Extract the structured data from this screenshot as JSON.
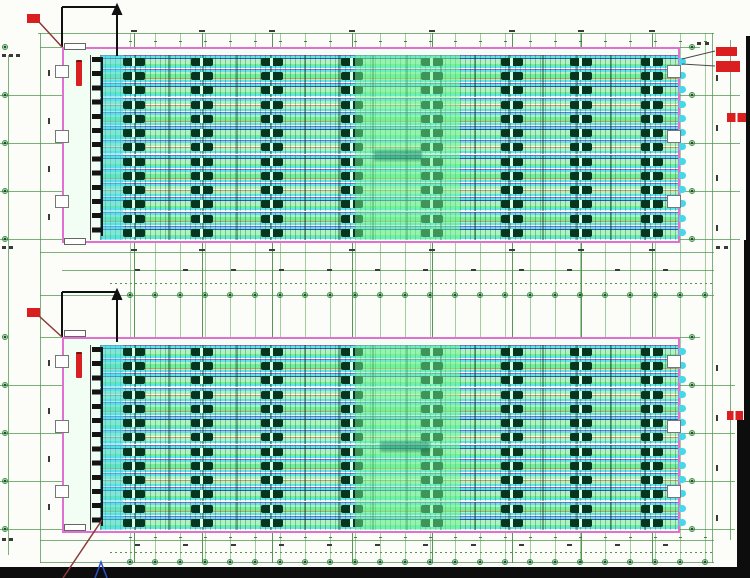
{
  "meta": {
    "description": "Scanned CAD floor plan: two identical long building plans with cage rows, dimension grids and red annotations. All small text is illegible at this resolution."
  },
  "canvas": {
    "w": 750,
    "h": 578,
    "bg": "#fcfcf9"
  },
  "palette": {
    "border_magenta": "#e26fd2",
    "grid_fine": "rgba(90,165,90,0.55)",
    "grid_bay": "rgba(60,130,60,0.85)",
    "grid_margin": "rgba(80,150,80,0.75)",
    "tick_dark": "#3a3a3a",
    "red": "#d91f1f",
    "leader_red": "#8a3a34",
    "leader_gray": "#4a4a4a",
    "cut_black": "#111111",
    "wall_black": "#141414",
    "blue_mark": "#2b50c8",
    "cyan_tint": "rgba(80,220,230,0.50)",
    "green_tint": "rgba(120,245,150,0.50)"
  },
  "grid": {
    "fine_x": {
      "start": 130,
      "step": 25,
      "count": 24,
      "y1": 33,
      "y2": 563
    },
    "bay_x": [
      123,
      191,
      261,
      341,
      421,
      501,
      570,
      641
    ],
    "margin_v": [
      {
        "x": 8,
        "y1": 55,
        "y2": 555
      },
      {
        "x": 40,
        "y1": 33,
        "y2": 563
      },
      {
        "x": 712,
        "y1": 33,
        "y2": 563
      },
      {
        "x": 730,
        "y1": 40,
        "y2": 540
      }
    ],
    "h_lines": [
      {
        "y": 33,
        "x1": 38,
        "x2": 714
      },
      {
        "y": 47,
        "x1": 40,
        "x2": 62
      },
      {
        "y": 47,
        "x1": 680,
        "x2": 700
      },
      {
        "y": 95,
        "x1": 0,
        "x2": 62
      },
      {
        "y": 95,
        "x1": 680,
        "x2": 740
      },
      {
        "y": 143,
        "x1": 0,
        "x2": 62
      },
      {
        "y": 143,
        "x1": 680,
        "x2": 740
      },
      {
        "y": 191,
        "x1": 0,
        "x2": 62
      },
      {
        "y": 191,
        "x1": 680,
        "x2": 740
      },
      {
        "y": 239,
        "x1": 0,
        "x2": 62
      },
      {
        "y": 239,
        "x1": 680,
        "x2": 740
      },
      {
        "y": 252,
        "x1": 40,
        "x2": 714
      },
      {
        "y": 270,
        "x1": 62,
        "x2": 714
      },
      {
        "y": 295,
        "x1": 40,
        "x2": 714
      },
      {
        "y": 337,
        "x1": 40,
        "x2": 62
      },
      {
        "y": 337,
        "x1": 680,
        "x2": 700
      },
      {
        "y": 385,
        "x1": 0,
        "x2": 62
      },
      {
        "y": 385,
        "x1": 680,
        "x2": 735
      },
      {
        "y": 433,
        "x1": 0,
        "x2": 62
      },
      {
        "y": 433,
        "x1": 680,
        "x2": 735
      },
      {
        "y": 481,
        "x1": 0,
        "x2": 62
      },
      {
        "y": 481,
        "x1": 680,
        "x2": 735
      },
      {
        "y": 529,
        "x1": 0,
        "x2": 62
      },
      {
        "y": 529,
        "x1": 680,
        "x2": 735
      },
      {
        "y": 540,
        "x1": 40,
        "x2": 714
      },
      {
        "y": 562,
        "x1": 40,
        "x2": 714
      }
    ],
    "dot_lines": [
      {
        "y": 283,
        "x1": 110,
        "x2": 714
      },
      {
        "y": 552,
        "x1": 110,
        "x2": 714
      }
    ]
  },
  "dimension_rows": [
    {
      "y": 30,
      "kind": "bay"
    },
    {
      "y": 41,
      "kind": "fine"
    },
    {
      "y": 249,
      "kind": "bay"
    },
    {
      "y": 269,
      "kind": "mid"
    },
    {
      "y": 292,
      "kind": "bubble"
    },
    {
      "y": 544,
      "kind": "mid"
    },
    {
      "y": 537,
      "kind": "fine"
    },
    {
      "y": 559,
      "kind": "bubble"
    }
  ],
  "mid_ticks": {
    "start": 135,
    "step": 48,
    "count": 12
  },
  "plan_internal": {
    "cage": {
      "dx": 38,
      "dy": 8,
      "w": 578,
      "h": 185,
      "rows": 13
    },
    "row_types": [
      "a",
      "b",
      "a",
      "c",
      "b",
      "a",
      "c",
      "a",
      "b",
      "c",
      "a",
      "b",
      "a"
    ],
    "cluster_cols": [
      123,
      191,
      261,
      341,
      421,
      501,
      570,
      641
    ],
    "sawtooth": {
      "dx": 30,
      "w": 9
    },
    "wall_dx": 28,
    "doors_dy": [
      18,
      83,
      148
    ],
    "door": {
      "w": 14,
      "h": 13
    },
    "tints": [
      {
        "dx": 38,
        "w": 23,
        "color": "cyan_tint"
      },
      {
        "dx": 293,
        "w": 105,
        "color": "green_tint"
      }
    ]
  },
  "plans": [
    {
      "id": "plan-1",
      "x": 62,
      "y": 47,
      "w": 618,
      "h": 196,
      "cut_symbol": {
        "corner_x": 62,
        "top_y": 7,
        "h_x2": 117,
        "v_y2": 47,
        "arrow_x": 117,
        "arrow_y1": 4,
        "arrow_y2": 56
      },
      "red_block": {
        "x": 27,
        "y": 14,
        "w": 13,
        "h": 9
      },
      "red_leader": {
        "x1": 39,
        "y1": 22,
        "x2": 62,
        "y2": 47
      },
      "red_bar": {
        "x": 76,
        "y": 60,
        "w": 6,
        "h": 24
      },
      "right_red_blocks": [
        {
          "x": 716,
          "y": 47,
          "w": 21,
          "h": 9
        },
        {
          "x": 716,
          "y": 61,
          "w": 24,
          "h": 11
        }
      ],
      "right_leaders": [
        {
          "x1": 682,
          "y1": 59,
          "x2": 715,
          "y2": 51
        },
        {
          "x1": 682,
          "y1": 64,
          "x2": 715,
          "y2": 66
        }
      ],
      "edge_red_text": {
        "x": 727,
        "y": 113,
        "w": 20,
        "h": 9
      },
      "label_patch": {
        "x": 374,
        "y": 150,
        "w": 48,
        "h": 11
      },
      "wboxes": [
        {
          "x": 64,
          "y": 43,
          "w": 22,
          "h": 7
        },
        {
          "x": 64,
          "y": 238,
          "w": 22,
          "h": 7
        }
      ]
    },
    {
      "id": "plan-2",
      "x": 62,
      "y": 337,
      "w": 618,
      "h": 196,
      "cut_symbol": {
        "corner_x": 62,
        "top_y": 292,
        "h_x2": 117,
        "v_y2": 337,
        "arrow_x": 117,
        "arrow_y1": 289,
        "arrow_y2": 342
      },
      "red_block": {
        "x": 27,
        "y": 308,
        "w": 13,
        "h": 9
      },
      "red_leader": {
        "x1": 39,
        "y1": 316,
        "x2": 62,
        "y2": 337
      },
      "red_bar": {
        "x": 76,
        "y": 352,
        "w": 6,
        "h": 24
      },
      "right_red_blocks": [],
      "right_leaders": [],
      "edge_red_text": {
        "x": 727,
        "y": 411,
        "w": 16,
        "h": 9
      },
      "label_patch": {
        "x": 380,
        "y": 441,
        "w": 50,
        "h": 11
      },
      "wboxes": [
        {
          "x": 64,
          "y": 330,
          "w": 22,
          "h": 7
        },
        {
          "x": 64,
          "y": 524,
          "w": 22,
          "h": 7
        }
      ]
    }
  ],
  "margin_bubbles": {
    "left_x": 2,
    "right_x": 689,
    "ys": [
      47,
      95,
      143,
      191,
      239,
      337,
      385,
      433,
      481,
      529
    ]
  },
  "side_ticks": {
    "left_x": 48,
    "left_ys": [
      70,
      118,
      166,
      214,
      360,
      408,
      456,
      504
    ],
    "right_x": 716,
    "right_ys": [
      75,
      125,
      175,
      225,
      365,
      415,
      465,
      515
    ]
  },
  "corner_marks": [
    {
      "x": 2,
      "y": 54
    },
    {
      "x": 9,
      "y": 54
    },
    {
      "x": 16,
      "y": 54
    },
    {
      "x": 2,
      "y": 246
    },
    {
      "x": 9,
      "y": 246
    },
    {
      "x": 716,
      "y": 246
    },
    {
      "x": 724,
      "y": 246
    },
    {
      "x": 2,
      "y": 538
    },
    {
      "x": 9,
      "y": 538
    },
    {
      "x": 697,
      "y": 42
    },
    {
      "x": 705,
      "y": 42
    }
  ],
  "frame_bars": [
    {
      "x": 0,
      "y": 567,
      "w": 750,
      "h": 11
    },
    {
      "x": 746,
      "y": 36,
      "w": 4,
      "h": 204
    },
    {
      "x": 744,
      "y": 240,
      "w": 6,
      "h": 182
    },
    {
      "x": 737,
      "y": 420,
      "w": 13,
      "h": 158
    }
  ],
  "misc": {
    "bottom_diagonal": {
      "x1": 102,
      "y1": 520,
      "x2": 63,
      "y2": 578
    },
    "blue_mark": {
      "points": "95,578 101,562 107,578"
    }
  }
}
